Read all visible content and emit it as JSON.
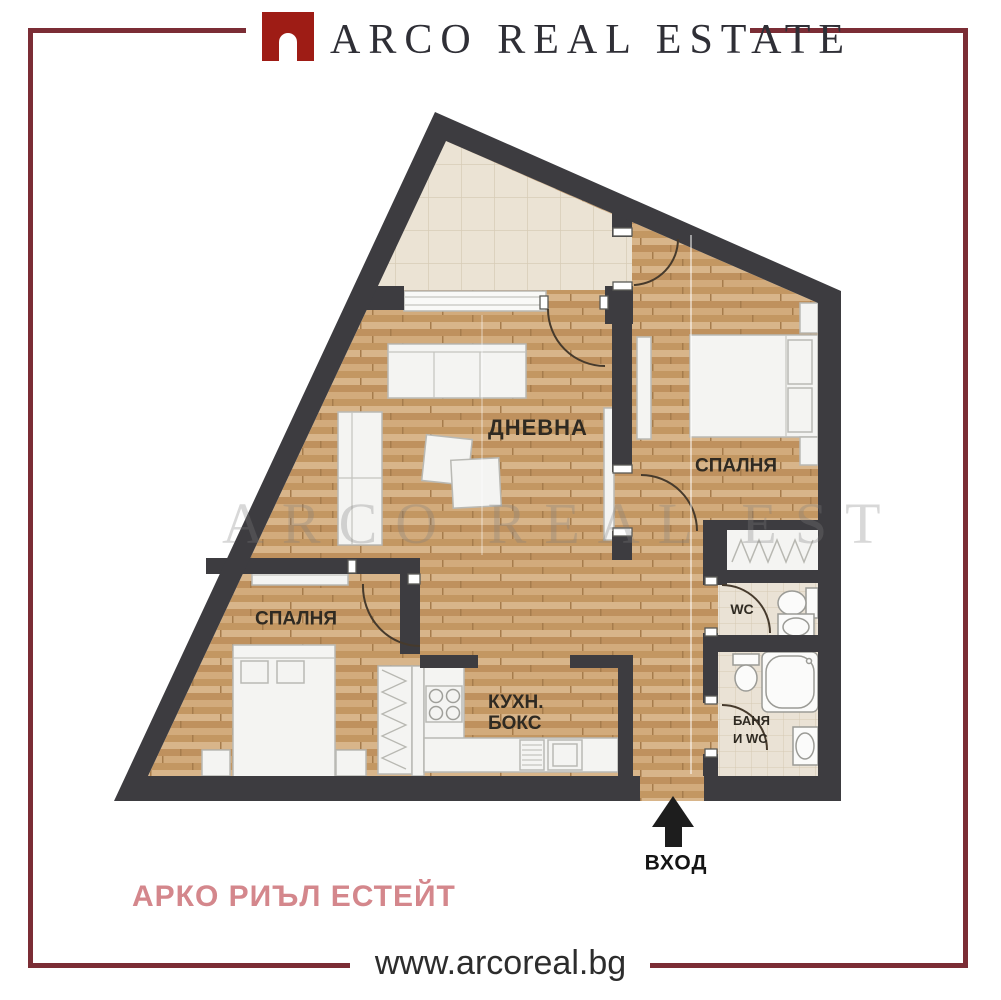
{
  "header": {
    "logo_text": "ARCO REAL ESTATE"
  },
  "watermark": {
    "text": "ARCO REAL ESTATE"
  },
  "floorplan": {
    "rooms": {
      "living": "ДНЕВНА",
      "bedroom_right": "СПАЛНЯ",
      "bedroom_left": "СПАЛНЯ",
      "kitchen_line1": "КУХН.",
      "kitchen_line2": "БОКС",
      "wc": "WC",
      "bath_line1": "БАНЯ",
      "bath_line2": "И WC",
      "entrance": "ВХОД"
    },
    "colors": {
      "wall": "#3d3c40",
      "wood": "#cda67a",
      "terrace_tile": "#ebe3d4",
      "bath_tile": "#eae2d5",
      "accent_red": "#9e1c15",
      "frame_maroon": "#7b2d35",
      "brand_pink": "#d4878c"
    }
  },
  "footer": {
    "brand_name": "АРКО РИЪЛ ЕСТЕЙТ",
    "website": "www.arcoreal.bg"
  }
}
